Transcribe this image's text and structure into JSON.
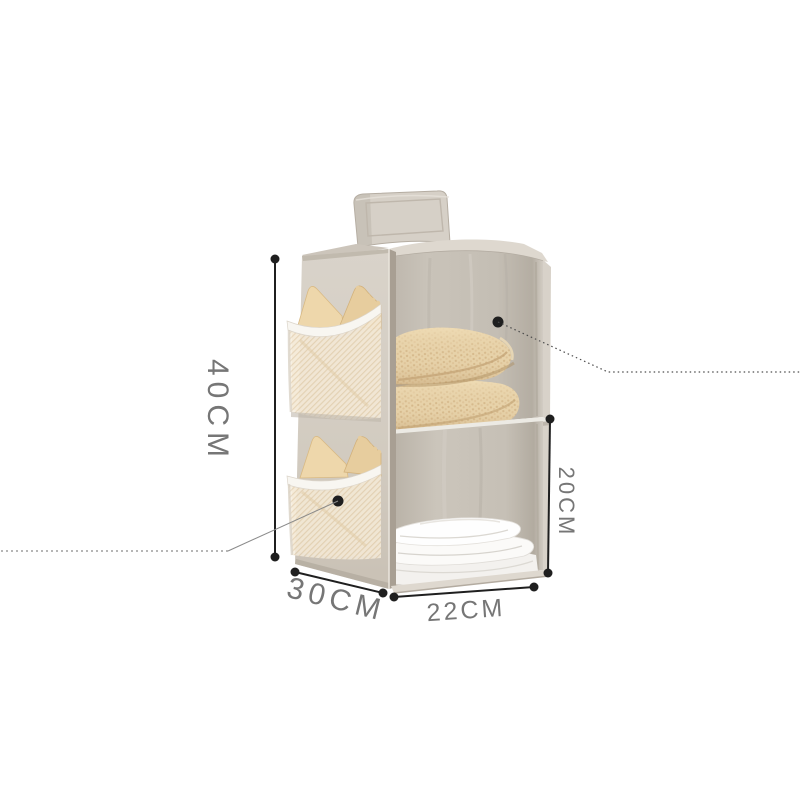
{
  "image": {
    "type": "product-photo",
    "subject": "hanging fabric closet organizer with two shelf compartments, two side mesh pockets holding tan bras, a folded beige knit blanket on the top shelf and folded white clothes on the bottom shelf, hung by a top strap"
  },
  "dimensions": {
    "height": "40CM",
    "depth": "30CM",
    "width": "22CM",
    "compartment_height": "20CM"
  },
  "colors": {
    "background": "#ffffff",
    "annotation-line": "#1f1f1f",
    "label-text": "#767676",
    "fabric-light": "#d7d1c8",
    "fabric-mid": "#cdc6bb",
    "fabric-interior": "#c6c0b6",
    "mesh": "#f4ead9",
    "trim-white": "#f8f6f1",
    "item-tan": "#e9d0a2",
    "blanket-tan": "#e6d0a8",
    "clothes-white": "#fbfaf8"
  }
}
